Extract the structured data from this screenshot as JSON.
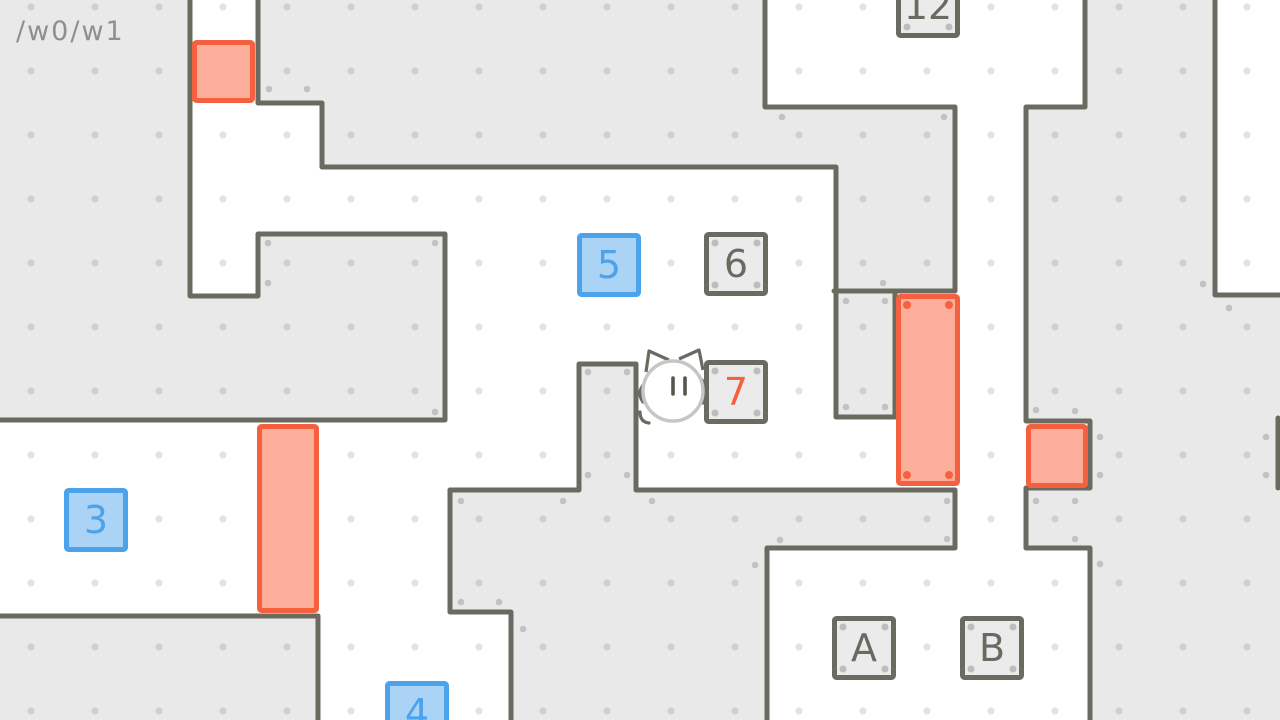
{
  "hud": {
    "level_path": "/w0/w1"
  },
  "colors": {
    "background": "#e9e9e9",
    "room_white": "#ffffff",
    "wall": "#6b6a60",
    "grid_dot": "rgba(0,0,0,0.115)",
    "deco_dot": "#c2c2c2",
    "blue_fill": "#abd3f5",
    "blue_border": "#4da2ec",
    "blue_text": "#4da2ec",
    "gray_fill": "#ebebeb",
    "gray_border": "#6b6a60",
    "gray_text": "#6b6a60",
    "red_fill": "#fcae9b",
    "red_border": "#f5613f",
    "red_text": "#f5613f",
    "char_outline": "#c6c6c6",
    "char_features": "#57564e",
    "hud_text": "#8f8f8f"
  },
  "grid": {
    "size": 64,
    "dot_cx": 31,
    "dot_cy": 7,
    "dot_r": 3.5
  },
  "maze": {
    "width": 1280,
    "height": 720,
    "wall_thickness": 5,
    "white_regions": [
      [
        190,
        0,
        68,
        297
      ],
      [
        258,
        101,
        66,
        68
      ],
      [
        190,
        167,
        648,
        69
      ],
      [
        443,
        167,
        395,
        325
      ],
      [
        834,
        417,
        126,
        73
      ],
      [
        894,
        291,
        66,
        197
      ],
      [
        0,
        420,
        452,
        198
      ],
      [
        318,
        610,
        195,
        110
      ],
      [
        763,
        0,
        324,
        109
      ],
      [
        956,
        0,
        70,
        550
      ],
      [
        1026,
        419,
        66,
        71
      ],
      [
        765,
        548,
        327,
        172
      ],
      [
        1215,
        0,
        65,
        297
      ]
    ],
    "gray_islands": [
      [
        581,
        366,
        53,
        127
      ],
      [
        838,
        293,
        55,
        122
      ]
    ],
    "walls": [
      [
        [
          190,
          -4
        ],
        [
          190,
          296
        ],
        [
          258,
          296
        ],
        [
          258,
          234
        ],
        [
          445,
          234
        ],
        [
          445,
          420
        ],
        [
          -6,
          420
        ]
      ],
      [
        [
          258,
          -4
        ],
        [
          258,
          103
        ],
        [
          322,
          103
        ],
        [
          322,
          167
        ],
        [
          836,
          167
        ],
        [
          836,
          417
        ],
        [
          895,
          417
        ],
        [
          895,
          291
        ],
        [
          834,
          291
        ]
      ],
      [
        [
          450,
          490
        ],
        [
          579,
          490
        ],
        [
          579,
          364
        ],
        [
          636,
          364
        ],
        [
          636,
          490
        ],
        [
          955,
          490
        ],
        [
          955,
          548
        ],
        [
          767,
          548
        ],
        [
          767,
          724
        ]
      ],
      [
        [
          450,
          490
        ],
        [
          450,
          612
        ],
        [
          511,
          612
        ],
        [
          511,
          724
        ]
      ],
      [
        [
          -6,
          616
        ],
        [
          318,
          616
        ],
        [
          318,
          724
        ]
      ],
      [
        [
          765,
          -4
        ],
        [
          765,
          107
        ],
        [
          955,
          107
        ],
        [
          955,
          291
        ],
        [
          897,
          291
        ]
      ],
      [
        [
          1085,
          -4
        ],
        [
          1085,
          107
        ],
        [
          1026,
          107
        ],
        [
          1026,
          421
        ],
        [
          1090,
          421
        ],
        [
          1090,
          488
        ],
        [
          1026,
          488
        ],
        [
          1026,
          548
        ],
        [
          1090,
          548
        ],
        [
          1090,
          724
        ]
      ],
      [
        [
          1215,
          -4
        ],
        [
          1215,
          295
        ],
        [
          1284,
          295
        ]
      ],
      [
        [
          1278,
          418
        ],
        [
          1278,
          488
        ]
      ]
    ],
    "deco_dots": [
      [
        269,
        89
      ],
      [
        307,
        89
      ],
      [
        782,
        117
      ],
      [
        944,
        117
      ],
      [
        1203,
        284
      ],
      [
        1229,
        308
      ],
      [
        883,
        283
      ],
      [
        268,
        243
      ],
      [
        435,
        243
      ],
      [
        268,
        283
      ],
      [
        435,
        412
      ],
      [
        588,
        372
      ],
      [
        627,
        372
      ],
      [
        588,
        475
      ],
      [
        627,
        475
      ],
      [
        846,
        301
      ],
      [
        885,
        301
      ],
      [
        846,
        407
      ],
      [
        885,
        407
      ],
      [
        461,
        501
      ],
      [
        563,
        501
      ],
      [
        652,
        501
      ],
      [
        461,
        602
      ],
      [
        499,
        602
      ],
      [
        523,
        629
      ],
      [
        947,
        501
      ],
      [
        947,
        539
      ],
      [
        780,
        540
      ],
      [
        755,
        565
      ],
      [
        1036,
        410
      ],
      [
        1036,
        501
      ],
      [
        1075,
        411
      ],
      [
        1100,
        437
      ],
      [
        1100,
        475
      ],
      [
        1266,
        437
      ],
      [
        1266,
        475
      ],
      [
        1075,
        501
      ],
      [
        1075,
        539
      ],
      [
        1100,
        564
      ]
    ]
  },
  "boxes": [
    {
      "id": "box-3",
      "label": "3",
      "type": "blue",
      "x": 64,
      "y": 488,
      "w": 64,
      "h": 64,
      "corner_dots": false
    },
    {
      "id": "box-4",
      "label": "4",
      "type": "blue",
      "x": 385,
      "y": 681,
      "w": 64,
      "h": 64,
      "corner_dots": false
    },
    {
      "id": "box-5",
      "label": "5",
      "type": "blue",
      "x": 577,
      "y": 233,
      "w": 64,
      "h": 64,
      "corner_dots": false
    },
    {
      "id": "box-6",
      "label": "6",
      "type": "gray",
      "x": 704,
      "y": 232,
      "w": 64,
      "h": 64,
      "corner_dots": true
    },
    {
      "id": "box-7",
      "label": "7",
      "type": "gray",
      "x": 704,
      "y": 360,
      "w": 64,
      "h": 64,
      "corner_dots": true,
      "label_color_key": "red_text"
    },
    {
      "id": "box-12",
      "label": "12",
      "type": "gray",
      "x": 896,
      "y": -26,
      "w": 64,
      "h": 64,
      "corner_dots": true
    },
    {
      "id": "box-A",
      "label": "A",
      "type": "gray",
      "x": 832,
      "y": 616,
      "w": 64,
      "h": 64,
      "corner_dots": true
    },
    {
      "id": "box-B",
      "label": "B",
      "type": "gray",
      "x": 960,
      "y": 616,
      "w": 64,
      "h": 64,
      "corner_dots": true
    },
    {
      "id": "crate-top-left",
      "label": "",
      "type": "red",
      "x": 192,
      "y": 40,
      "w": 63,
      "h": 63,
      "corner_dots": false
    },
    {
      "id": "crate-left",
      "label": "",
      "type": "red",
      "x": 257,
      "y": 424,
      "w": 62,
      "h": 189,
      "corner_dots": false
    },
    {
      "id": "crate-tall",
      "label": "",
      "type": "red",
      "x": 896,
      "y": 294,
      "w": 64,
      "h": 192,
      "corner_dots": true
    },
    {
      "id": "crate-east",
      "label": "",
      "type": "red",
      "x": 1026,
      "y": 424,
      "w": 62,
      "h": 64,
      "corner_dots": false
    }
  ],
  "character": {
    "name": "cat-player",
    "cx": 673,
    "cy": 391,
    "r": 30,
    "ears": [
      "M646,372 L649,351 L669,360",
      "M679,359 L699,350 L703,370"
    ],
    "eyes": [
      [
        673,
        378,
        673,
        394
      ],
      [
        685,
        378,
        685,
        394
      ]
    ],
    "limbs": [
      "M645,383 Q636,392 643,402",
      "M702,380 Q711,391 703,403",
      "M640,412 Q640,422 649,423"
    ]
  }
}
